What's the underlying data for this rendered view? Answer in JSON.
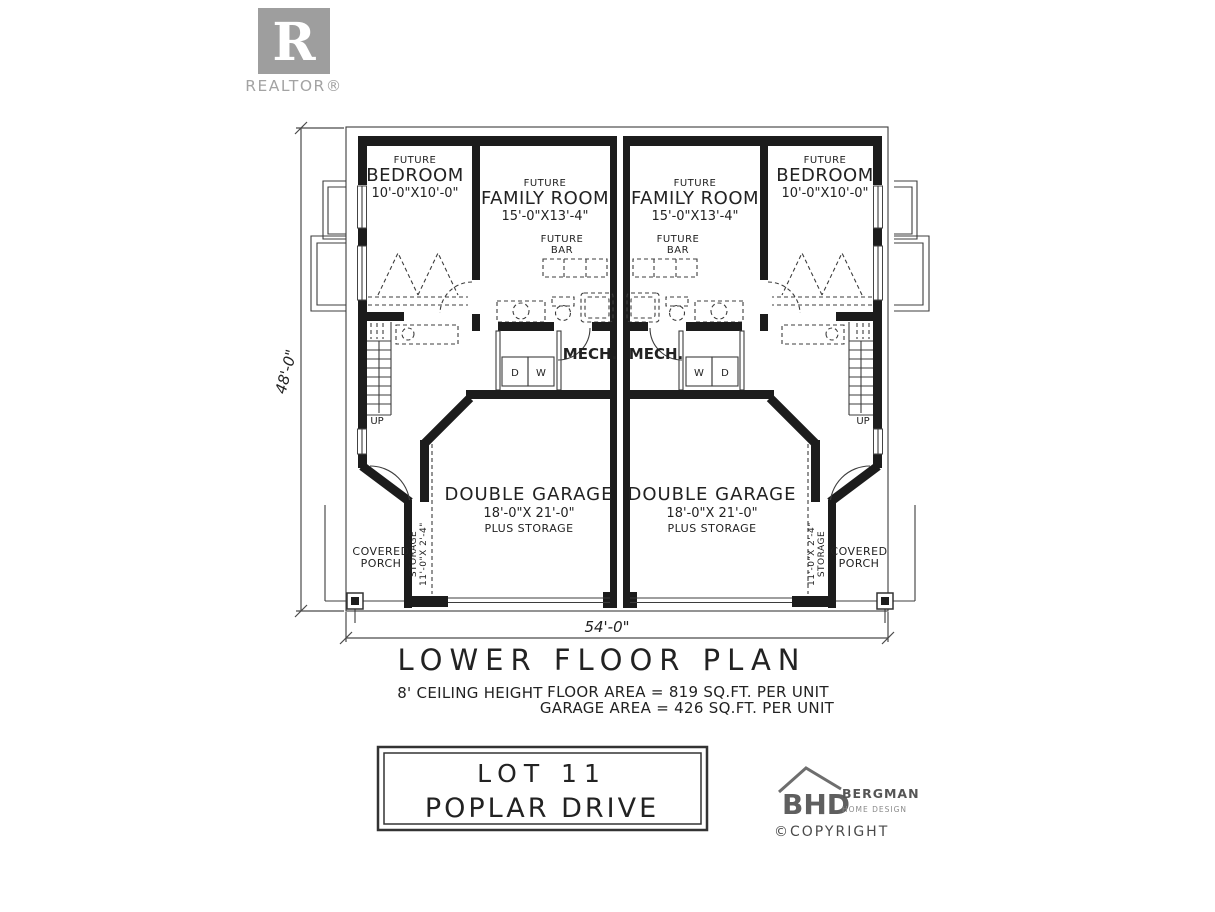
{
  "realtor": {
    "letter": "R",
    "wordmark": "REALTOR®"
  },
  "rooms": {
    "future": "FUTURE",
    "bedroom": {
      "name": "BEDROOM",
      "dims": "10'-0\"X10'-0\""
    },
    "family_room": {
      "name": "FAMILY ROOM",
      "dims": "15'-0\"X13'-4\""
    },
    "bar": "BAR",
    "mech": "MECH.",
    "laundry": {
      "washer": "W",
      "dryer": "D"
    },
    "garage": {
      "name": "DOUBLE GARAGE",
      "dims": "18'-0\"X 21'-0\"",
      "note": "PLUS STORAGE"
    },
    "storage": {
      "name": "STORAGE",
      "dims": "11'-0\"X 2'-4\""
    },
    "porch": {
      "line1": "COVERED",
      "line2": "PORCH"
    },
    "stairs": "UP"
  },
  "dimensions": {
    "width": "54'-0\"",
    "height": "48'-0\""
  },
  "title_block": {
    "title": "LOWER FLOOR PLAN",
    "ceiling": "8' CEILING HEIGHT",
    "floor_area": "FLOOR AREA = 819 SQ.FT. PER UNIT",
    "garage_area": "GARAGE AREA = 426 SQ.FT. PER UNIT"
  },
  "lot": {
    "line1": "LOT 11",
    "line2": "POPLAR DRIVE"
  },
  "designer": {
    "monogram": "BHD",
    "name": "BERGMAN",
    "tagline": "HOME DESIGN",
    "copyright": "©COPYRIGHT"
  }
}
